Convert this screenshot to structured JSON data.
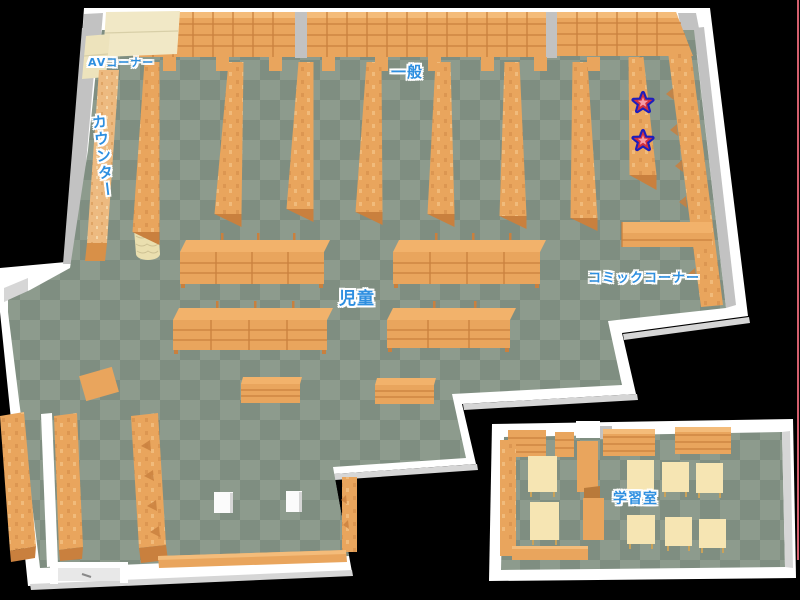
{
  "map": {
    "kind": "library-floor-map",
    "labels": {
      "av_corner": "AVコーナー",
      "general": "一般",
      "counter": "カウンター",
      "children": "児童",
      "comic_corner": "コミックコーナー",
      "study_room": "学習室"
    },
    "markers": {
      "stars": [
        {
          "id": "star-1",
          "x": 643,
          "y": 103
        },
        {
          "id": "star-2",
          "x": 643,
          "y": 141
        }
      ]
    }
  },
  "colors": {
    "floor_light": "#8D9B8D",
    "floor_dark": "#7F8E81",
    "wall": "#FFFFFF",
    "wall_shade": "#C2C2C2",
    "wall_face": "#DEDEDE",
    "shelf": "#E9A55D",
    "shelf_top": "#F2B26B",
    "shelf_dark": "#C9803E",
    "cream": "#F1E8C6",
    "table": "#F6E5B3",
    "label_blue": "#2E8FE0",
    "star_fill": "#D3303E",
    "star_inner": "#F79BA4",
    "star_outline": "#1D1DBE",
    "edge_line": "#D4606E"
  }
}
